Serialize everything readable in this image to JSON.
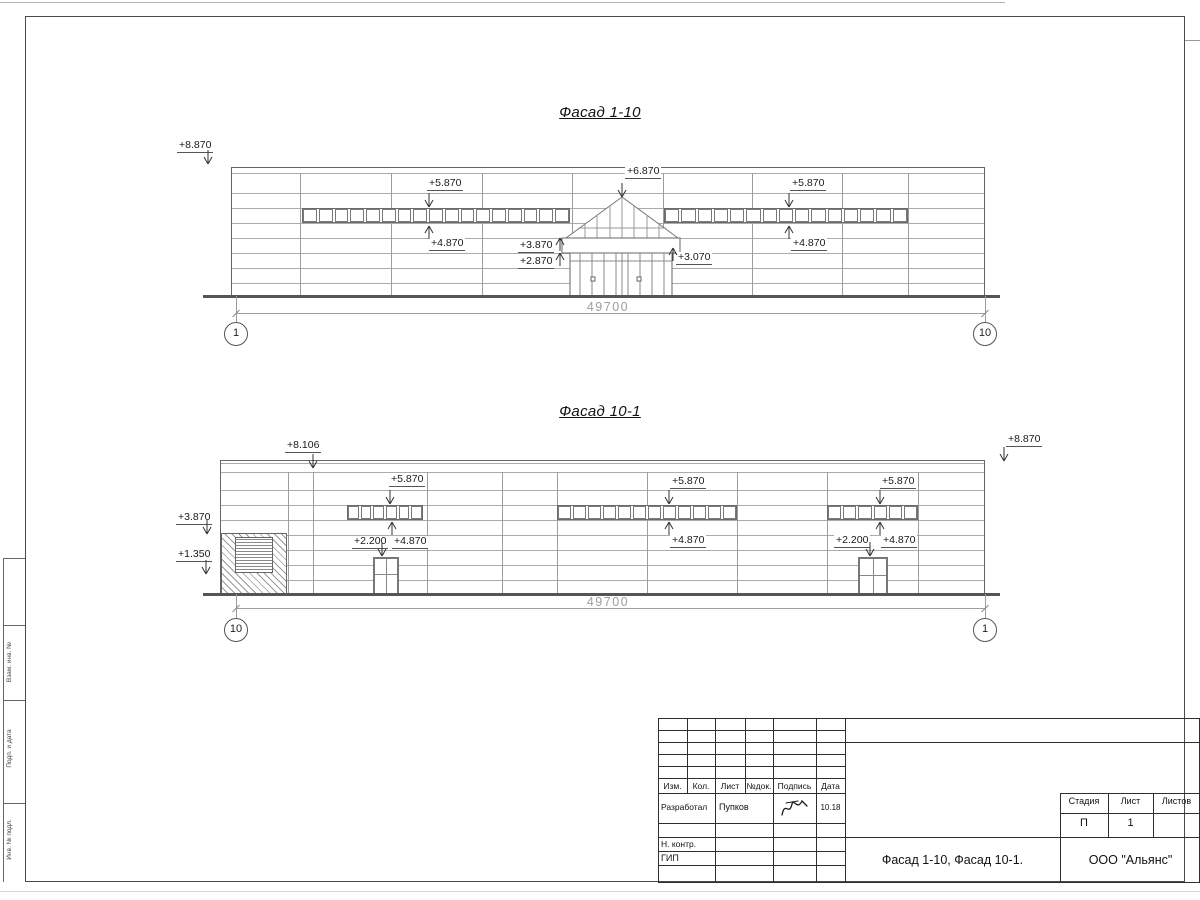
{
  "drawing": {
    "facades": [
      {
        "id": "facade-1-10",
        "title": "Фасад 1-10",
        "title_cx": 600,
        "title_y": 104,
        "box": {
          "x": 231,
          "y": 167,
          "w": 754,
          "h": 130
        },
        "vstart": 173,
        "hlines": [
          173,
          193,
          208,
          223,
          238,
          253,
          268,
          283
        ],
        "vlines": [
          300,
          391,
          482,
          572,
          663,
          752,
          842,
          908
        ],
        "bands": [
          {
            "x": 302,
            "y": 208,
            "w": 268,
            "h": 15,
            "n": 17
          },
          {
            "x": 664,
            "y": 208,
            "w": 244,
            "h": 15,
            "n": 15
          }
        ],
        "entrance": {
          "x": 540,
          "y": 188,
          "w": 152,
          "h": 112
        },
        "ground": {
          "x1": 203,
          "x2": 1000,
          "y": 296
        },
        "dim": {
          "x1": 236,
          "x2": 985,
          "y": 313,
          "label": "49700",
          "cx": 608,
          "ext_top": 296,
          "ext_bot": 322
        },
        "axes": [
          {
            "label": "1",
            "cx": 236,
            "cy": 334
          },
          {
            "label": "10",
            "cx": 985,
            "cy": 334
          }
        ],
        "markers": [
          {
            "label": "+8.870",
            "tx": 177,
            "ty": 140,
            "ax": 208,
            "ay": 164,
            "dir": "down"
          },
          {
            "label": "+5.870",
            "tx": 427,
            "ty": 178,
            "ax": 429,
            "ay": 207,
            "dir": "down"
          },
          {
            "label": "+4.870",
            "tx": 429,
            "ty": 238,
            "ax": 429,
            "ay": 225,
            "dir": "up"
          },
          {
            "label": "+6.870",
            "tx": 625,
            "ty": 166,
            "ax": 622,
            "ay": 197,
            "dir": "down"
          },
          {
            "label": "+3.870",
            "tx": 518,
            "ty": 240,
            "ax": 560,
            "ay": 237,
            "dir": "up"
          },
          {
            "label": "+2.870",
            "tx": 518,
            "ty": 256,
            "ax": 560,
            "ay": 252,
            "dir": "up"
          },
          {
            "label": "+3.070",
            "tx": 676,
            "ty": 252,
            "ax": 673,
            "ay": 247,
            "dir": "up"
          },
          {
            "label": "+5.870",
            "tx": 790,
            "ty": 178,
            "ax": 789,
            "ay": 207,
            "dir": "down"
          },
          {
            "label": "+4.870",
            "tx": 791,
            "ty": 238,
            "ax": 789,
            "ay": 225,
            "dir": "up"
          }
        ]
      },
      {
        "id": "facade-10-1",
        "title": "Фасад 10-1",
        "title_cx": 600,
        "title_y": 403,
        "box": {
          "x": 220,
          "y": 460,
          "w": 765,
          "h": 135
        },
        "vstart": 472,
        "hlines": [
          463,
          472,
          490,
          505,
          520,
          535,
          550,
          565,
          580
        ],
        "vlines": [
          288,
          313,
          427,
          502,
          557,
          647,
          737,
          827,
          918
        ],
        "bands": [
          {
            "x": 347,
            "y": 505,
            "w": 76,
            "h": 15,
            "n": 6
          },
          {
            "x": 557,
            "y": 505,
            "w": 180,
            "h": 15,
            "n": 12
          },
          {
            "x": 827,
            "y": 505,
            "w": 91,
            "h": 15,
            "n": 6
          }
        ],
        "hatch": {
          "x": 221,
          "y": 533,
          "w": 66,
          "h": 62,
          "louver": [
            235,
            537,
            38,
            36
          ]
        },
        "doors": [
          [
            373,
            557,
            26,
            38
          ],
          [
            858,
            557,
            30,
            39
          ]
        ],
        "ground": {
          "x1": 203,
          "x2": 1000,
          "y": 594
        },
        "dim": {
          "x1": 236,
          "x2": 985,
          "y": 608,
          "label": "49700",
          "cx": 608,
          "ext_top": 594,
          "ext_bot": 618
        },
        "axes": [
          {
            "label": "10",
            "cx": 236,
            "cy": 630
          },
          {
            "label": "1",
            "cx": 985,
            "cy": 630
          }
        ],
        "markers": [
          {
            "label": "+8.106",
            "tx": 285,
            "ty": 440,
            "ax": 313,
            "ay": 468,
            "dir": "down"
          },
          {
            "label": "+8.870",
            "tx": 1006,
            "ty": 434,
            "ax": 1004,
            "ay": 461,
            "dir": "down"
          },
          {
            "label": "+3.870",
            "tx": 176,
            "ty": 512,
            "ax": 207,
            "ay": 534,
            "dir": "down"
          },
          {
            "label": "+1.350",
            "tx": 176,
            "ty": 549,
            "ax": 206,
            "ay": 574,
            "dir": "down"
          },
          {
            "label": "+5.870",
            "tx": 389,
            "ty": 474,
            "ax": 390,
            "ay": 504,
            "dir": "down"
          },
          {
            "label": "+2.200",
            "tx": 352,
            "ty": 536,
            "ax": 382,
            "ay": 556,
            "dir": "down"
          },
          {
            "label": "+4.870",
            "tx": 392,
            "ty": 536,
            "ax": 392,
            "ay": 521,
            "dir": "up"
          },
          {
            "label": "+5.870",
            "tx": 670,
            "ty": 476,
            "ax": 669,
            "ay": 504,
            "dir": "down"
          },
          {
            "label": "+4.870",
            "tx": 670,
            "ty": 535,
            "ax": 669,
            "ay": 521,
            "dir": "up"
          },
          {
            "label": "+5.870",
            "tx": 880,
            "ty": 476,
            "ax": 880,
            "ay": 504,
            "dir": "down"
          },
          {
            "label": "+2.200",
            "tx": 834,
            "ty": 535,
            "ax": 870,
            "ay": 556,
            "dir": "down"
          },
          {
            "label": "+4.870",
            "tx": 881,
            "ty": 535,
            "ax": 880,
            "ay": 521,
            "dir": "up"
          }
        ]
      }
    ],
    "title_block": {
      "rev_headers": [
        "Изм.",
        "Кол.",
        "Лист",
        "№док.",
        "Подпись",
        "Дата"
      ],
      "developed_label": "Разработал",
      "developed_name": "Пупков",
      "date": "10.18",
      "ncontr_label": "Н. контр.",
      "gip_label": "ГИП",
      "stage_label": "Стадия",
      "sheet_label": "Лист",
      "sheets_label": "Листов",
      "stage_value": "П",
      "sheet_value": "1",
      "sheets_value": "",
      "doc_title": "Фасад 1-10, Фасад 10-1.",
      "company": "ООО \"Альянс\""
    },
    "side_strip": {
      "labels": [
        "Взам. инв. №",
        "Подп. и дата",
        "Инв. № подл."
      ]
    }
  }
}
